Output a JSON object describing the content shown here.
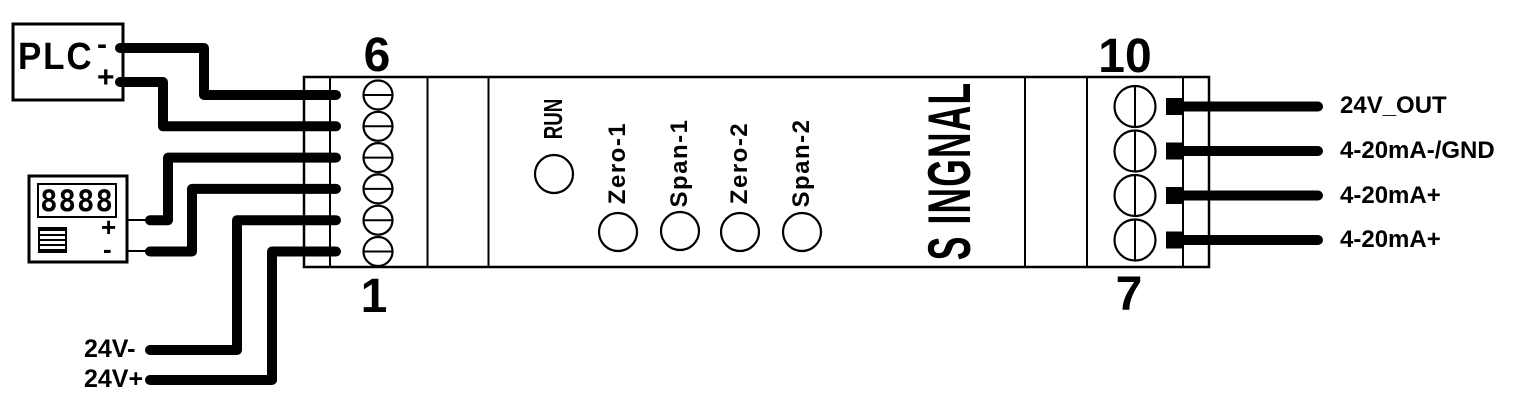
{
  "diagram": {
    "plc": {
      "label": "PLC",
      "minus": "-",
      "plus": "+"
    },
    "display": {
      "value": "8888",
      "plus": "+",
      "minus": "-"
    },
    "module": {
      "left_terminal_top": "6",
      "left_terminal_bottom": "1",
      "right_terminal_top": "10",
      "right_terminal_bottom": "7",
      "run_led": "RUN",
      "leds": [
        "Zero-1",
        "Span-1",
        "Zero-2",
        "Span-2"
      ],
      "side_label": "S INGNAL"
    },
    "left_wire_labels": {
      "v_minus": "24V-",
      "v_plus": "24V+"
    },
    "right_wire_labels": [
      "24V_OUT",
      "4-20mA-/GND",
      "4-20mA+",
      "4-20mA+"
    ]
  },
  "colors": {
    "stroke": "#000000",
    "background": "#ffffff"
  }
}
